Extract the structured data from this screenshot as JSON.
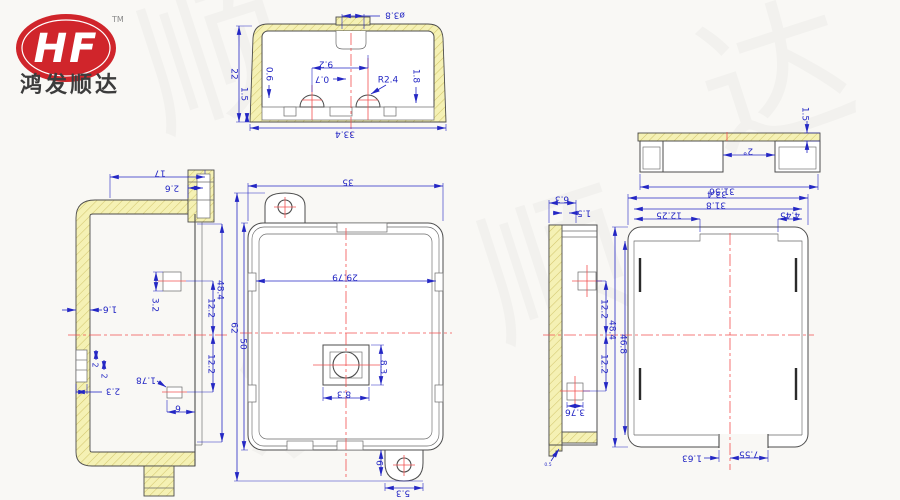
{
  "brand": {
    "logo_text": "HF",
    "tm": "TM",
    "company": "鸿发顺达"
  },
  "watermark": {
    "w1": "顺",
    "w2": "达",
    "w3": "发",
    "w4": "顺"
  },
  "colors": {
    "dimension": "#2427c4",
    "outline": "#4d4d4d",
    "centerline": "#f25050",
    "hatch": "#f5f1b4",
    "logo_red": "#d0252b"
  },
  "views": {
    "section": {
      "dia": "ø3.8",
      "height": "22",
      "foot": "1.5",
      "step": "0.6",
      "pitch": "9.2",
      "offset": "0.7",
      "radius": "R2.4",
      "wall": "1.8",
      "width": "33.4"
    },
    "side_left": {
      "top_width": "17",
      "tab_width": "2.6",
      "wall": "1.6",
      "boss_height": "3.2",
      "upper_offset": "12.2",
      "overall": "48.4",
      "lower_offset": "12.2",
      "step_a": "2",
      "step_b": "2",
      "step_depth": "2.3",
      "boss2_height": "1.78",
      "edge_gap": "6"
    },
    "front": {
      "overall_width": "35",
      "inner_width": "29.79",
      "overall_height": "62",
      "body_height": "50",
      "boss_width": "8.3",
      "boss_height": "8.3",
      "tab_offset": "6",
      "tab_width": "5.3"
    },
    "side_right": {
      "depth": "6.3",
      "rim": "1.5",
      "upper_offset": "12.2",
      "lower_offset": "12.2",
      "boss_width": "3.76",
      "note": "0.5"
    },
    "channel": {
      "overall_width": "33.4",
      "inner_width": "31.8",
      "flange_left": "12.25",
      "flange_right": "4.45",
      "overall_height": "48.4",
      "inner_height": "46.8",
      "slot_offset": "1.63",
      "slot_width": "7.55"
    },
    "strip": {
      "rim": "1.5",
      "draft_angle": "2°",
      "width": "31.56"
    }
  }
}
